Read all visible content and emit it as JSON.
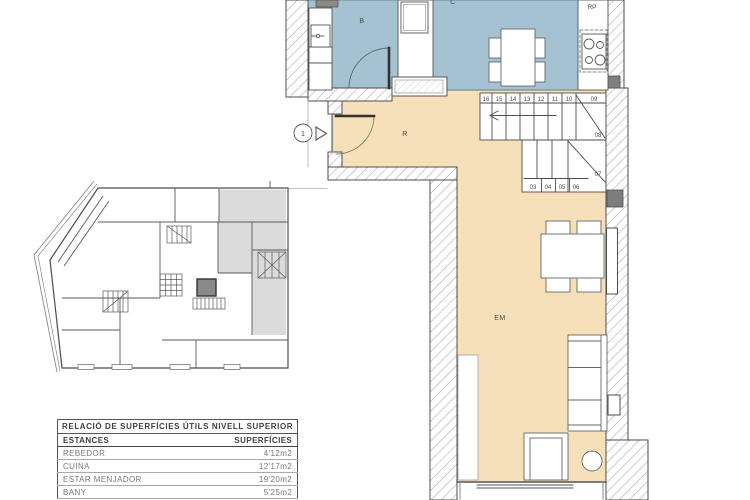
{
  "sheet": {
    "areas_table": {
      "title": "RELACIÓ DE SUPERFÍCIES ÚTILS NIVELL SUPERIOR",
      "col_room": "ESTANCES",
      "col_area": "SUPERFÍCIES",
      "rows": [
        {
          "name": "REBEDOR",
          "area": "4'12m2"
        },
        {
          "name": "CUINA",
          "area": "12'17m2"
        },
        {
          "name": "ESTAR MENJADOR",
          "area": "19'20m2"
        },
        {
          "name": "BANY",
          "area": "5'25m2"
        }
      ]
    },
    "labels": {
      "bany": "B",
      "cuina": "C",
      "rebedor": "R",
      "estar_menjador": "EM",
      "rp": "RP",
      "entrance_number": "1"
    },
    "stairs": {
      "upper": [
        "16",
        "15",
        "14",
        "13",
        "12",
        "11",
        "10"
      ],
      "t09": "09",
      "t08": "08",
      "t07": "07",
      "lower": [
        "03",
        "04",
        "05",
        "06"
      ]
    },
    "colors": {
      "wet_room_fill": "#a4c2d2",
      "dry_room_fill": "#f6e0ba",
      "overview_shaded": "#dbdbdb"
    }
  }
}
